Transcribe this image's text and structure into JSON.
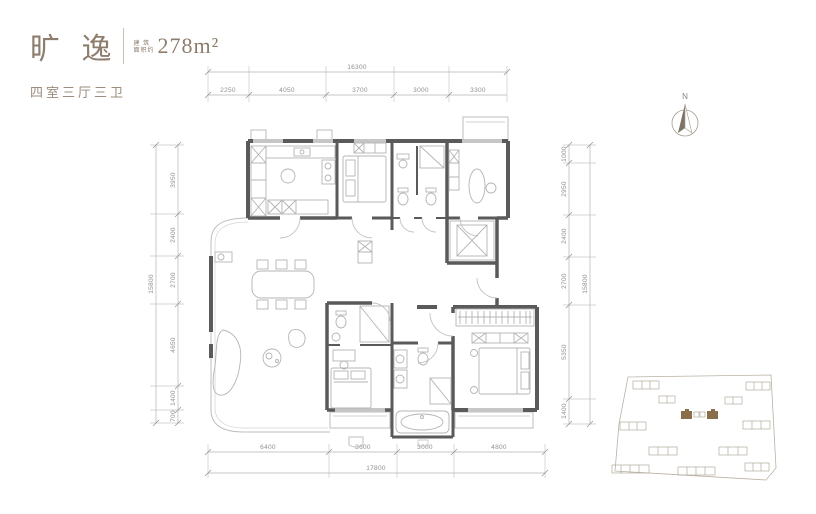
{
  "header": {
    "title": "旷 逸",
    "area_label_line1": "建 筑",
    "area_label_line2": "面积约",
    "area_value": "278m²",
    "layout_type": "四室三厅三卫"
  },
  "dimensions": {
    "top": {
      "total": "16300",
      "segments": [
        "2250",
        "4050",
        "3700",
        "3000",
        "3300"
      ]
    },
    "bottom": {
      "total": "17800",
      "segments": [
        "6400",
        "3600",
        "3000",
        "4800"
      ]
    },
    "left": {
      "total": "15800",
      "segments": [
        "3950",
        "2400",
        "2700",
        "4650",
        "1400",
        "700"
      ]
    },
    "right": {
      "total": "15800",
      "segments": [
        "1000",
        "2950",
        "2400",
        "2700",
        "5350",
        "1400"
      ]
    }
  },
  "compass": {
    "label": "N"
  },
  "colors": {
    "accent_brown": "#8d7d6d",
    "wall": "#5a5a5a",
    "furniture_line": "#b4b4b4",
    "dimension_line": "#a8a8a8",
    "site_highlight": "#8a6d49"
  }
}
